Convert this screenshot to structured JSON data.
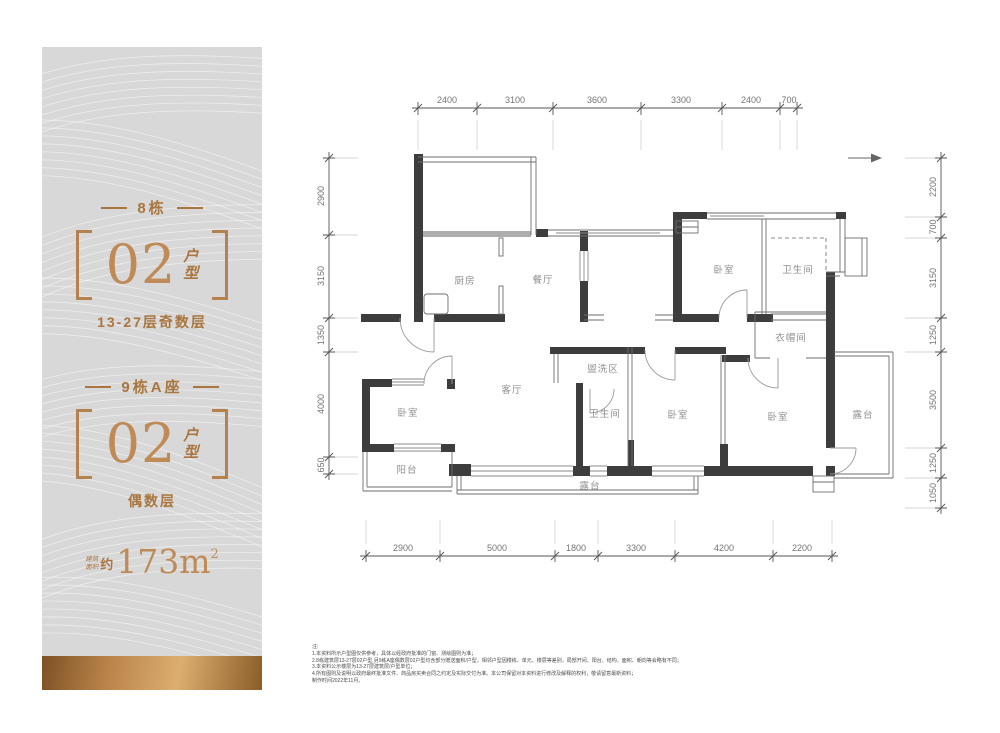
{
  "panel": {
    "block1": {
      "title": "8栋",
      "number": "02",
      "suffix_top": "户",
      "suffix_bottom": "型",
      "floors": "13-27层奇数层"
    },
    "block2": {
      "title": "9栋A座",
      "number": "02",
      "suffix_top": "户",
      "suffix_bottom": "型",
      "floors": "偶数层"
    },
    "area": {
      "label_top": "建筑",
      "label_bottom": "面积",
      "approx": "约",
      "value": "173m",
      "sup": "2"
    }
  },
  "plan": {
    "rooms": [
      {
        "label": "厨房"
      },
      {
        "label": "餐厅"
      },
      {
        "label": "卧室"
      },
      {
        "label": "卫生间"
      },
      {
        "label": "衣帽间"
      },
      {
        "label": "客厅"
      },
      {
        "label": "盥洗区"
      },
      {
        "label": "卫生间"
      },
      {
        "label": "卧室"
      },
      {
        "label": "卧室"
      },
      {
        "label": "卧室"
      },
      {
        "label": "露台"
      },
      {
        "label": "露台"
      },
      {
        "label": "阳台"
      }
    ],
    "dims": {
      "top": [
        "2400",
        "3100",
        "3600",
        "3300",
        "2400",
        "700"
      ],
      "bottom": [
        "2900",
        "5000",
        "1800",
        "3300",
        "4200",
        "2200"
      ],
      "left": [
        "2900",
        "3150",
        "1350",
        "4000",
        "650"
      ],
      "right": [
        "2200",
        "700",
        "3150",
        "1250",
        "3500",
        "1250",
        "1050"
      ]
    }
  },
  "notes": {
    "lines": [
      "注:",
      "1.本资料所示户型图仅供参考，具体以经政府批准的门窗、测绘图则为准；",
      "2.8栋建筑层13-27层02户型,另9栋A座偶数层02户型均含部分赠送面积/户型，相邻户型因楼栋、单元、楼层等差别，局部开间、阳台、结构、面积、朝向等会略有不同；",
      "3.本资料公示楼层为13-27层建筑层/户型单位；",
      "4.所有图则及说明以政府最终批准文件、商品房买卖合同之约定及实际交付为准。本公司保留对本资料进行修改及解释的权利，敬请留意最新资料；",
      "制作时间2022年11月。"
    ]
  },
  "colors": {
    "bronze": "#b5814e",
    "wall": "#3d3d3d",
    "dim_text": "#757575",
    "room_text": "#8f8f8f",
    "panel_bg": "#d8d8d8",
    "gold_gradient": [
      "#7d5124",
      "#b9834a",
      "#dcae6f",
      "#8a5c28"
    ]
  }
}
